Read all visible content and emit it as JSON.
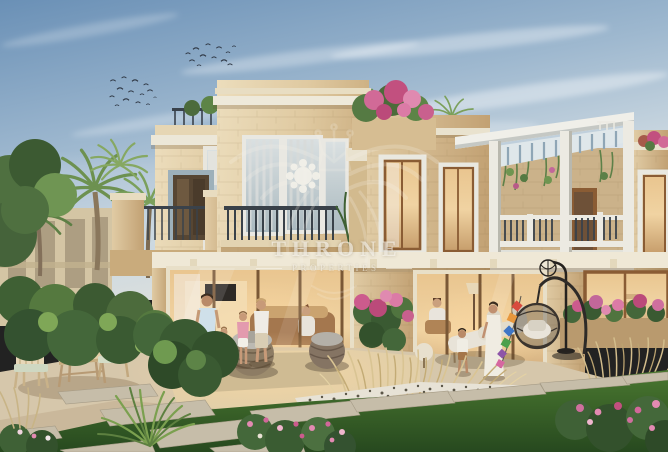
{
  "watermark": {
    "brand": "THRONE",
    "tagline": "PROPERTIES",
    "emblem": "crown-wings-emblem",
    "color": "rgba(252,249,242,0.6)"
  },
  "scene": {
    "elements": [
      "blue-sky",
      "wispy-clouds",
      "bird-flocks",
      "palm-trees",
      "stone-villa-facade",
      "balcony-railing",
      "roof-pergola",
      "bougainvillea-flowers",
      "sliding-glass-doors",
      "warm-interior-light",
      "family-walking",
      "woman-and-child-with-kite-garland",
      "wooden-table-and-chairs",
      "rattan-poufs",
      "hanging-egg-chair",
      "ornamental-grasses",
      "stone-path-slabs",
      "green-lawn",
      "pink-flower-bushes"
    ]
  },
  "palette": {
    "sky_top": "#6a90b6",
    "sky_horizon": "#dde2e0",
    "stone_light": "#ecdfc2",
    "stone_mid": "#dcc69e",
    "stone_shadow": "#bd9f74",
    "trim_white": "#eeeadd",
    "wood_frame": "#8a5c34",
    "railing_dark": "#3a424b",
    "pergola_slat": "#93abbc",
    "interior_glow": "#eec492",
    "foliage_dark": "#3d5c35",
    "foliage_light": "#7ea55c",
    "lawn_green": "#3a6730",
    "pampas_tan": "#d3bd8c",
    "flower_pink": "#cc5b8d",
    "paver_light": "#d6c9b2",
    "slab_gray": "#c3bbaa"
  }
}
